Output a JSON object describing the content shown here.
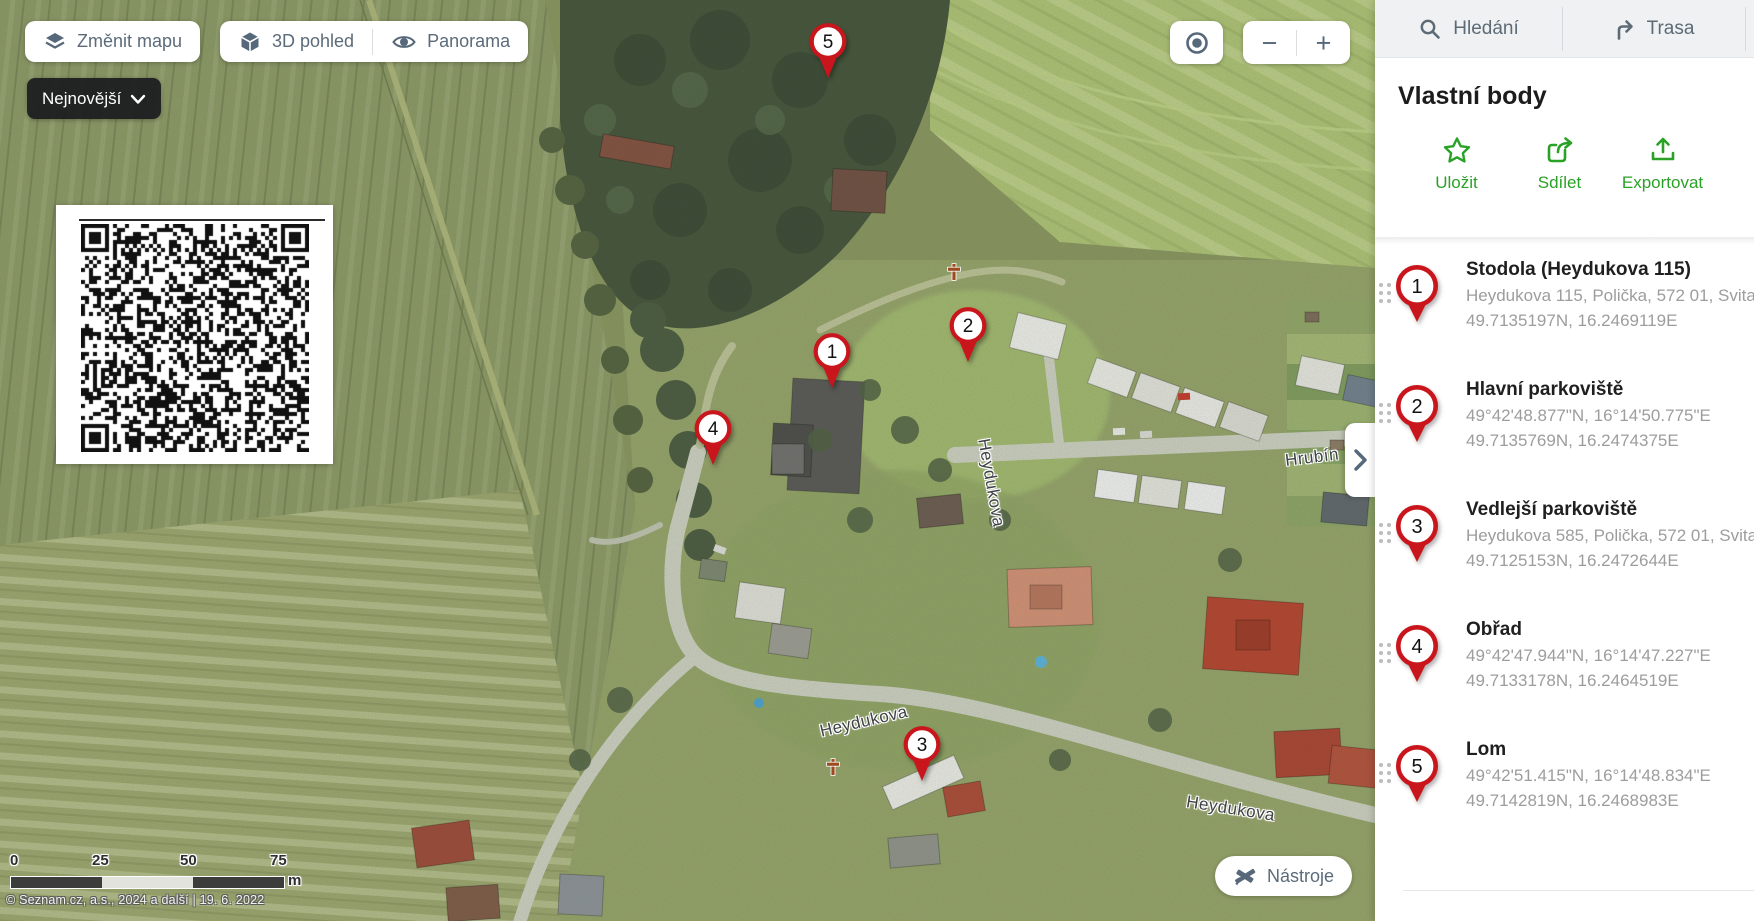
{
  "map_controls": {
    "change_map": "Změnit mapu",
    "view_3d": "3D pohled",
    "panorama": "Panorama",
    "newest": "Nejnovější",
    "tools": "Nástroje",
    "zoom_out": "−",
    "zoom_in": "+"
  },
  "scale_bar": {
    "ticks": [
      "0",
      "25",
      "50",
      "75"
    ],
    "unit": "m"
  },
  "attribution": "© Seznam.cz, a.s., 2024 a další | 19. 6. 2022",
  "street_labels": [
    {
      "text": "Heydukova"
    },
    {
      "text": "Hrubín"
    },
    {
      "text": "Heydukova"
    },
    {
      "text": "Heydukova"
    }
  ],
  "map_pins": [
    {
      "number": "1",
      "x": 832,
      "y": 388
    },
    {
      "number": "2",
      "x": 968,
      "y": 362
    },
    {
      "number": "3",
      "x": 922,
      "y": 781
    },
    {
      "number": "4",
      "x": 713,
      "y": 465
    },
    {
      "number": "5",
      "x": 828,
      "y": 78
    }
  ],
  "pin_colors": {
    "red": "#c9151c",
    "accent_green": "#2aa127",
    "slate": "#56687a"
  },
  "sidebar": {
    "tabs": [
      {
        "label": "Hledání"
      },
      {
        "label": "Trasa"
      }
    ],
    "title": "Vlastní body",
    "actions": [
      {
        "label": "Uložit"
      },
      {
        "label": "Sdílet"
      },
      {
        "label": "Exportovat"
      }
    ],
    "points": [
      {
        "number": "1",
        "title": "Stodola (Heydukova 115)",
        "line1": "Heydukova 115, Polička, 572 01, Svitavy",
        "line2": "49.7135197N, 16.2469119E"
      },
      {
        "number": "2",
        "title": "Hlavní parkoviště",
        "line1": "49°42'48.877\"N, 16°14'50.775\"E",
        "line2": "49.7135769N, 16.2474375E"
      },
      {
        "number": "3",
        "title": "Vedlejší parkoviště",
        "line1": "Heydukova 585, Polička, 572 01, Svitavy",
        "line2": "49.7125153N, 16.2472644E"
      },
      {
        "number": "4",
        "title": "Obřad",
        "line1": "49°42'47.944\"N, 16°14'47.227\"E",
        "line2": "49.7133178N, 16.2464519E"
      },
      {
        "number": "5",
        "title": "Lom",
        "line1": "49°42'51.415\"N, 16°14'48.834\"E",
        "line2": "49.7142819N, 16.2468983E"
      }
    ]
  }
}
